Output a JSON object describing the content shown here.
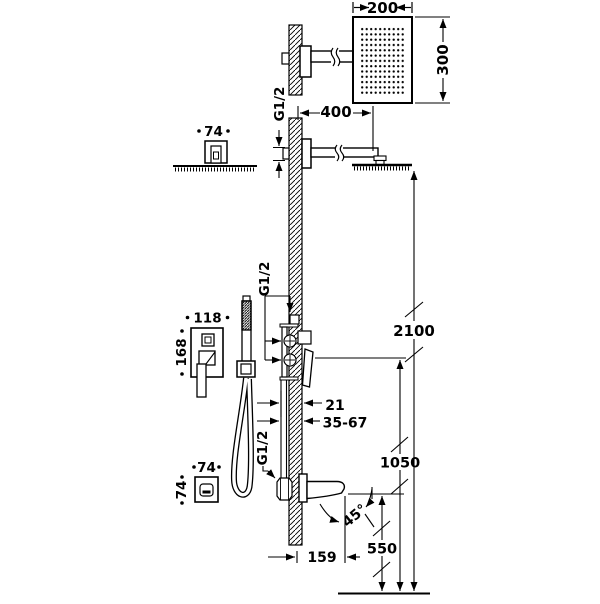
{
  "colors": {
    "line": "#000000",
    "background": "#ffffff"
  },
  "views": {
    "head_front": {
      "width": "200",
      "height": "300"
    },
    "head_side": {
      "arm_length": "400",
      "thread": "G1/2"
    },
    "arm_top": {
      "escutcheon_width": "74"
    },
    "mixer_front": {
      "plate_width": "118",
      "plate_height": "168"
    },
    "mixer_side": {
      "thread": "G1/2",
      "wall_offset": "21",
      "mounting_depth_range": "35-67"
    },
    "spout_side": {
      "thread": "G1/2",
      "projection": "159",
      "stream_angle": "45°"
    },
    "spout_front": {
      "escutcheon_width": "74",
      "escutcheon_height": "74"
    },
    "installation_heights": {
      "shower_head": "2100",
      "mixer_valve": "1050",
      "spout": "550"
    }
  }
}
